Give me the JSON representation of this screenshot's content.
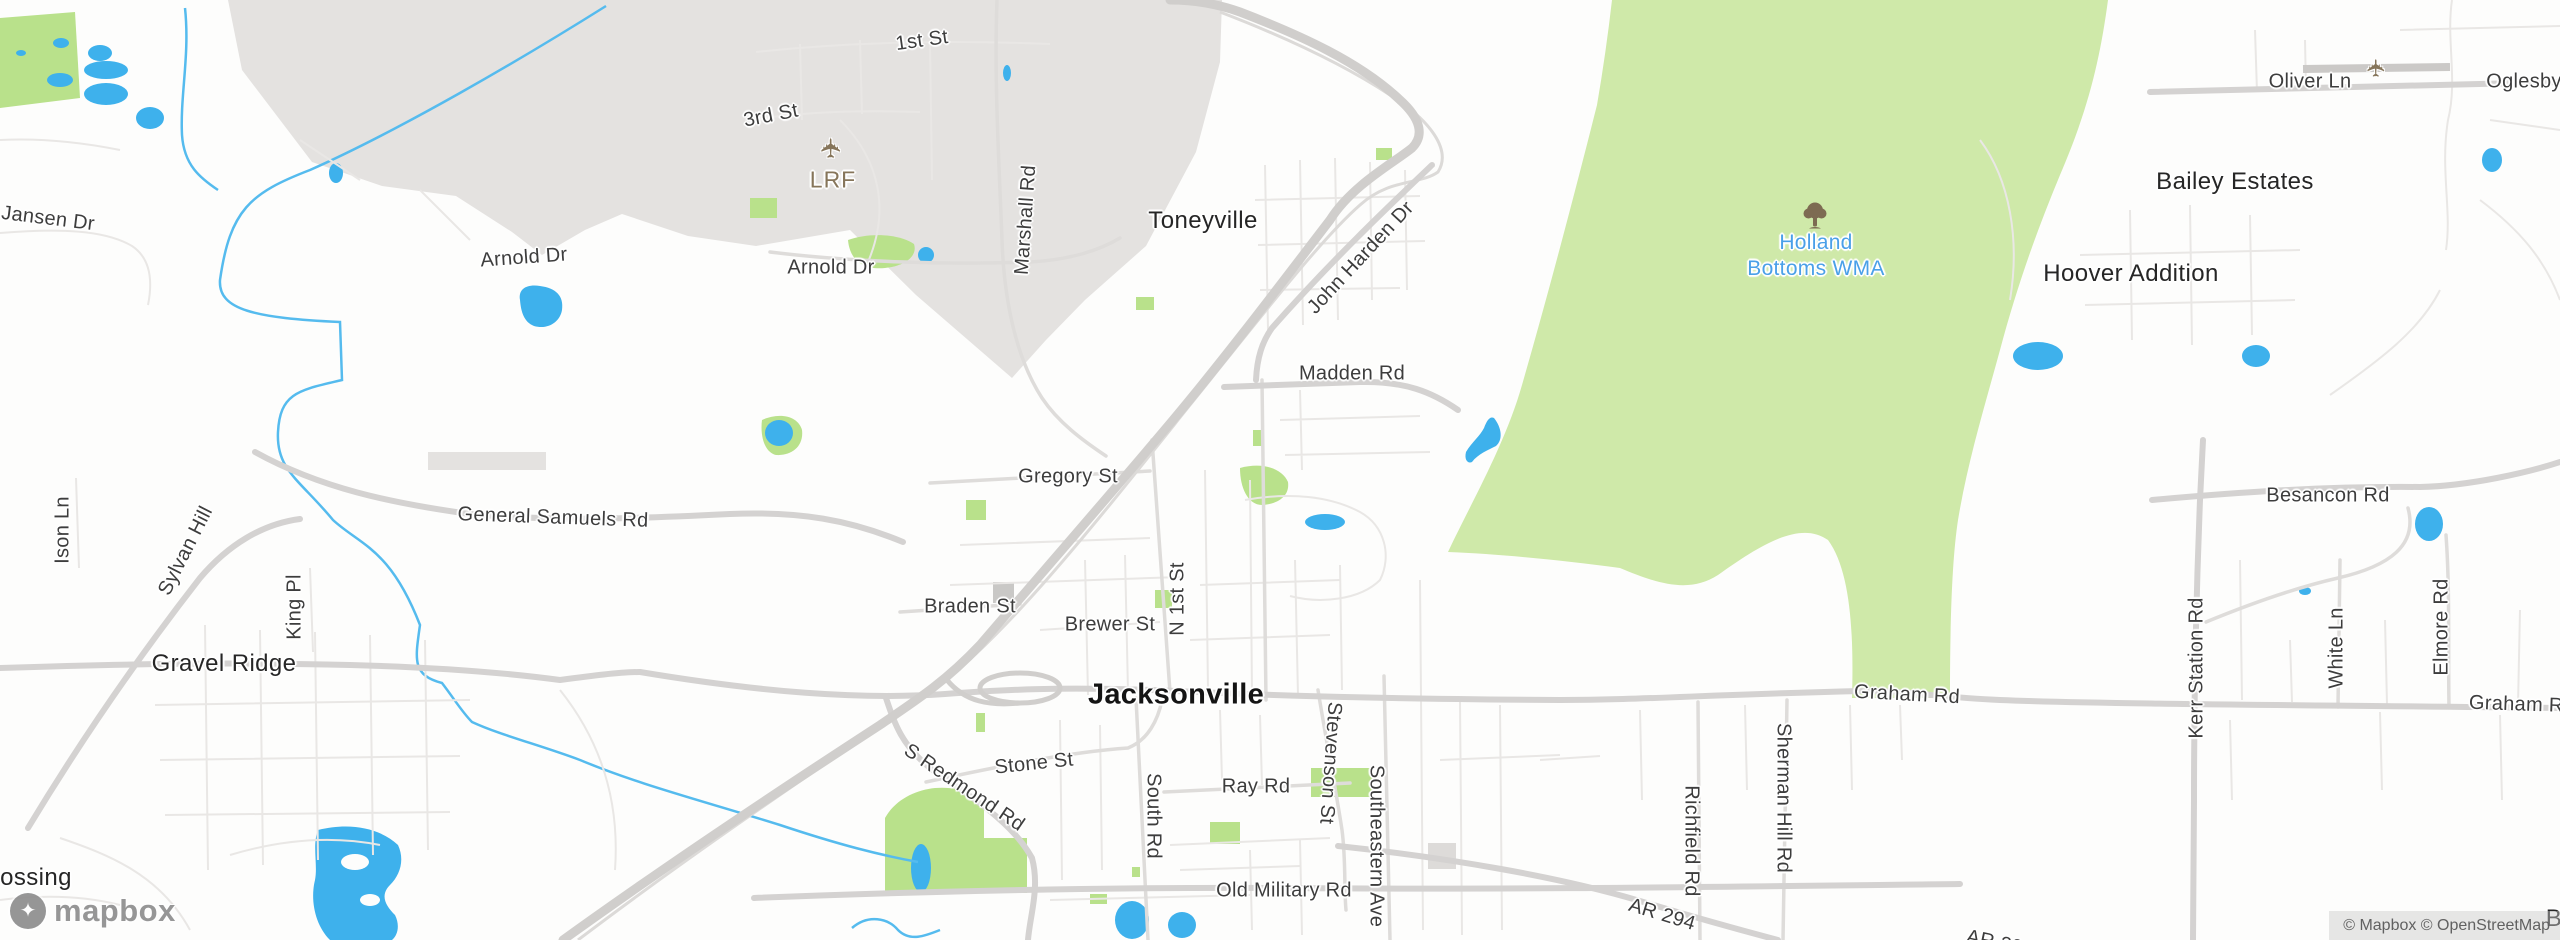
{
  "map": {
    "colors": {
      "land": "#fdfdfc",
      "urban_area": "#e4e2e0",
      "park_green": "#cfe9a9",
      "grass_green": "#b9e18b",
      "water_blue": "#3eb1ec",
      "stream_blue": "#55bbee",
      "road_major": "#d2d0ce",
      "road_medium": "#dedcda",
      "road_minor": "#eceae8",
      "road_label": "#3d3d3d",
      "place_label": "#262626",
      "city_label": "#141414",
      "park_label_blue": "#4aa0e8",
      "airport_brown": "#86755a"
    },
    "icons": {
      "airplane_glyph": "✈",
      "logo_pin_glyph": "✦"
    },
    "labels": {
      "city": {
        "jacksonville": "Jacksonville"
      },
      "places": {
        "toneyville": "Toneyville",
        "gravel_ridge": "Gravel Ridge",
        "bailey_estates": "Bailey Estates",
        "hoover_addition": "Hoover Addition",
        "crossing_partial": "ossing",
        "b_partial": "B"
      },
      "park": {
        "holland_line1": "Holland",
        "holland_line2": "Bottoms WMA"
      },
      "airport": {
        "code": "LRF"
      },
      "roads": {
        "first_st": "1st St",
        "third_st": "3rd St",
        "arnold_dr_w": "Arnold Dr",
        "arnold_dr_e": "Arnold Dr",
        "marshall_rd": "Marshall Rd",
        "jansen_dr": "Jansen Dr",
        "ison_ln": "Ison Ln",
        "sylvan_hill": "Sylvan Hill",
        "king_pl": "King Pl",
        "general_samuels_rd": "General Samuels Rd",
        "john_harden_dr": "John Harden Dr",
        "madden_rd": "Madden Rd",
        "gregory_st": "Gregory St",
        "braden_st": "Braden St",
        "brewer_st": "Brewer St",
        "n_1st_st": "N 1st St",
        "stone_st": "Stone St",
        "s_redmond_rd": "S Redmond Rd",
        "south_rd": "South Rd",
        "ray_rd": "Ray Rd",
        "stevenson_st": "Stevenson St",
        "southeastern_ave": "Southeastern Ave",
        "old_military_rd": "Old Military Rd",
        "ar_294": "AR 294",
        "ar_294_partial": "AR 294",
        "richfield_rd": "Richfield Rd",
        "sherman_hill_rd": "Sherman Hill Rd",
        "graham_rd": "Graham Rd",
        "graham_rd_east": "Graham Rd",
        "besancon_rd": "Besancon Rd",
        "kerr_station_rd": "Kerr Station Rd",
        "white_ln": "White Ln",
        "elmore_rd": "Elmore Rd",
        "oliver_ln": "Oliver Ln",
        "oglesby_rd": "Oglesby Rd"
      }
    },
    "logo": {
      "wordmark": "mapbox"
    },
    "attribution": {
      "text": "© Mapbox © OpenStreetMap"
    }
  }
}
